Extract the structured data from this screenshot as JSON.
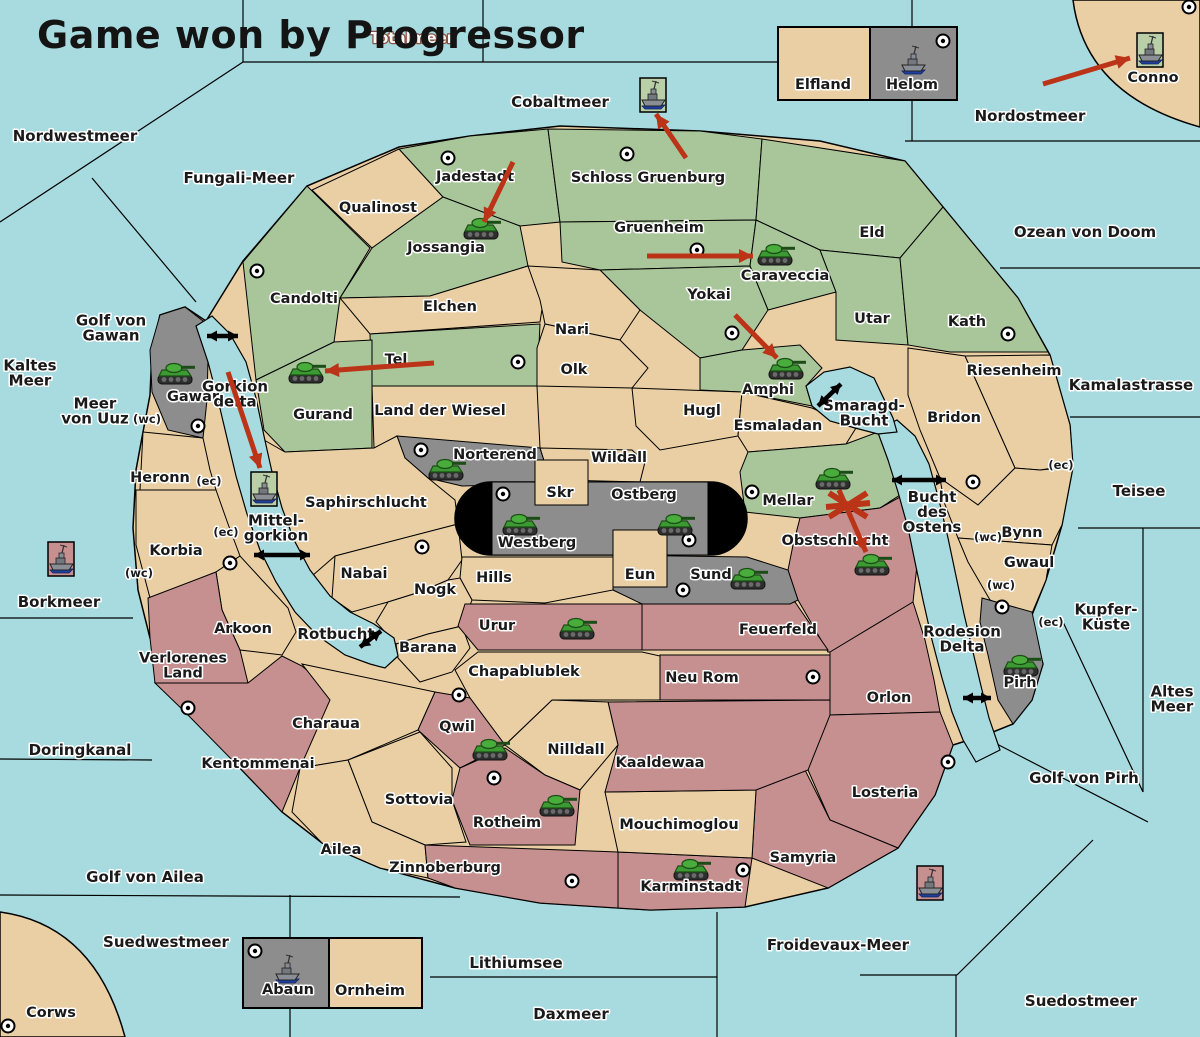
{
  "title": "Game won by Progressor",
  "colors": {
    "sea": "#a8dbe0",
    "land": "#e9cfa3",
    "green": "#a9c69a",
    "gray": "#8d8d8d",
    "rose": "#c69090",
    "capital": "#000000",
    "attack": "#bb3418",
    "link": "#000000",
    "ship_frame_green": "#b8cfa8",
    "ship_frame_rose": "#c69090"
  },
  "seas": [
    {
      "name": "Nordwestmeer",
      "x": 75,
      "y": 136
    },
    {
      "name": "Totalmeer",
      "x": 412,
      "y": 38,
      "inverse": true
    },
    {
      "name": "Cobaltmeer",
      "x": 560,
      "y": 102
    },
    {
      "name": "Nordostmeer",
      "x": 1030,
      "y": 116
    },
    {
      "name": "Ozean von Doom",
      "x": 1085,
      "y": 232
    },
    {
      "name": "Fungali-Meer",
      "x": 239,
      "y": 178
    },
    {
      "name": "Kaltes\nMeer",
      "x": 30,
      "y": 373
    },
    {
      "name": "Meer\nvon Uuz",
      "x": 95,
      "y": 411
    },
    {
      "name": "Golf von\nGawan",
      "x": 111,
      "y": 328
    },
    {
      "name": "Gorkion\ndelta",
      "x": 235,
      "y": 394
    },
    {
      "name": "Kamalastrasse",
      "x": 1131,
      "y": 385
    },
    {
      "name": "Teisee",
      "x": 1139,
      "y": 491
    },
    {
      "name": "Bucht\ndes\nOstens",
      "x": 932,
      "y": 512
    },
    {
      "name": "Smaragd-\nBucht",
      "x": 864,
      "y": 413
    },
    {
      "name": "Borkmeer",
      "x": 59,
      "y": 602
    },
    {
      "name": "Mittel-\ngorkion",
      "x": 276,
      "y": 528
    },
    {
      "name": "Kupfer-\nKüste",
      "x": 1106,
      "y": 617
    },
    {
      "name": "Altes\nMeer",
      "x": 1172,
      "y": 699
    },
    {
      "name": "Golf von Pirh",
      "x": 1084,
      "y": 778
    },
    {
      "name": "Rodesion\nDelta",
      "x": 962,
      "y": 639
    },
    {
      "name": "Rotbucht",
      "x": 336,
      "y": 634
    },
    {
      "name": "Doringkanal",
      "x": 80,
      "y": 750
    },
    {
      "name": "Golf von Ailea",
      "x": 145,
      "y": 877
    },
    {
      "name": "Suedwestmeer",
      "x": 166,
      "y": 942
    },
    {
      "name": "Lithiumsee",
      "x": 516,
      "y": 963
    },
    {
      "name": "Daxmeer",
      "x": 571,
      "y": 1014
    },
    {
      "name": "Froidevaux-Meer",
      "x": 838,
      "y": 945
    },
    {
      "name": "Suedostmeer",
      "x": 1081,
      "y": 1001
    }
  ],
  "regions": [
    {
      "name": "Candolti",
      "kind": "green",
      "x": 304,
      "y": 299
    },
    {
      "name": "Qualinost",
      "kind": "neutral",
      "x": 378,
      "y": 208
    },
    {
      "name": "Jadestadt",
      "kind": "green",
      "x": 475,
      "y": 177
    },
    {
      "name": "Schloss Gruenburg",
      "kind": "green",
      "x": 648,
      "y": 178
    },
    {
      "name": "Jossangia",
      "kind": "green",
      "x": 446,
      "y": 248
    },
    {
      "name": "Gruenheim",
      "kind": "green",
      "x": 659,
      "y": 228
    },
    {
      "name": "Eld",
      "kind": "green",
      "x": 872,
      "y": 233
    },
    {
      "name": "Caraveccia",
      "kind": "green",
      "x": 785,
      "y": 276
    },
    {
      "name": "Yokai",
      "kind": "green",
      "x": 709,
      "y": 295
    },
    {
      "name": "Utar",
      "kind": "green",
      "x": 872,
      "y": 319
    },
    {
      "name": "Kath",
      "kind": "green",
      "x": 967,
      "y": 322
    },
    {
      "name": "Amphi",
      "kind": "green",
      "x": 768,
      "y": 390
    },
    {
      "name": "Elchen",
      "kind": "neutral",
      "x": 450,
      "y": 307
    },
    {
      "name": "Nari",
      "kind": "neutral",
      "x": 572,
      "y": 330
    },
    {
      "name": "Tel",
      "kind": "green",
      "x": 396,
      "y": 360
    },
    {
      "name": "Olk",
      "kind": "neutral",
      "x": 574,
      "y": 370
    },
    {
      "name": "Gurand",
      "kind": "green",
      "x": 323,
      "y": 415
    },
    {
      "name": "Land der Wiesel",
      "kind": "neutral",
      "x": 440,
      "y": 411
    },
    {
      "name": "Hugl",
      "kind": "neutral",
      "x": 702,
      "y": 411
    },
    {
      "name": "Esmaladan",
      "kind": "neutral",
      "x": 778,
      "y": 426
    },
    {
      "name": "Mellar",
      "kind": "green",
      "x": 788,
      "y": 501
    },
    {
      "name": "Obstschlucht",
      "kind": "rose",
      "x": 835,
      "y": 541
    },
    {
      "name": "Wildall",
      "kind": "neutral",
      "x": 619,
      "y": 458
    },
    {
      "name": "Norterend",
      "kind": "gray",
      "x": 495,
      "y": 455
    },
    {
      "name": "Saphirschlucht",
      "kind": "neutral",
      "x": 366,
      "y": 503
    },
    {
      "name": "Nabai",
      "kind": "neutral",
      "x": 364,
      "y": 574
    },
    {
      "name": "Hills",
      "kind": "neutral",
      "x": 494,
      "y": 578
    },
    {
      "name": "Nogk",
      "kind": "neutral",
      "x": 435,
      "y": 590
    },
    {
      "name": "Barana",
      "kind": "neutral",
      "x": 428,
      "y": 648
    },
    {
      "name": "Heronn",
      "kind": "neutral",
      "x": 160,
      "y": 478
    },
    {
      "name": "Korbia",
      "kind": "neutral",
      "x": 176,
      "y": 551
    },
    {
      "name": "Arkoon",
      "kind": "neutral",
      "x": 243,
      "y": 629
    },
    {
      "name": "Verlorenes Land",
      "kind": "rose",
      "label": "Verlorenes\nLand",
      "x": 183,
      "y": 666
    },
    {
      "name": "Kentommenai",
      "kind": "rose",
      "x": 258,
      "y": 764
    },
    {
      "name": "Charaua",
      "kind": "neutral",
      "x": 326,
      "y": 724
    },
    {
      "name": "Sottovia",
      "kind": "neutral",
      "x": 419,
      "y": 800
    },
    {
      "name": "Ailea",
      "kind": "neutral",
      "x": 341,
      "y": 850
    },
    {
      "name": "Urur",
      "kind": "rose",
      "x": 497,
      "y": 626
    },
    {
      "name": "Feuerfeld",
      "kind": "rose",
      "x": 778,
      "y": 630
    },
    {
      "name": "Sund",
      "kind": "gray",
      "x": 711,
      "y": 575
    },
    {
      "name": "Neu Rom",
      "kind": "rose",
      "x": 702,
      "y": 678
    },
    {
      "name": "Orlon",
      "kind": "rose",
      "x": 889,
      "y": 698
    },
    {
      "name": "Losteria",
      "kind": "rose",
      "x": 885,
      "y": 793
    },
    {
      "name": "Samyria",
      "kind": "rose",
      "x": 803,
      "y": 858
    },
    {
      "name": "Karminstadt",
      "kind": "rose",
      "x": 691,
      "y": 887
    },
    {
      "name": "Zinnoberburg",
      "kind": "rose",
      "x": 445,
      "y": 868
    },
    {
      "name": "Mouchimoglou",
      "kind": "neutral",
      "x": 679,
      "y": 825
    },
    {
      "name": "Kaaldewaa",
      "kind": "rose",
      "x": 660,
      "y": 763
    },
    {
      "name": "Nilldall",
      "kind": "neutral",
      "x": 576,
      "y": 750
    },
    {
      "name": "Chapablublek",
      "kind": "neutral",
      "x": 524,
      "y": 672
    },
    {
      "name": "Qwil",
      "kind": "rose",
      "x": 457,
      "y": 727
    },
    {
      "name": "Rotheim",
      "kind": "rose",
      "x": 507,
      "y": 823
    },
    {
      "name": "Gawar",
      "kind": "gray",
      "x": 193,
      "y": 397
    },
    {
      "name": "Riesenheim",
      "kind": "neutral",
      "x": 1014,
      "y": 371
    },
    {
      "name": "Bridon",
      "kind": "neutral",
      "x": 954,
      "y": 418
    },
    {
      "name": "Bynn",
      "kind": "neutral",
      "x": 1022,
      "y": 533
    },
    {
      "name": "Gwaul",
      "kind": "neutral",
      "x": 1029,
      "y": 563
    },
    {
      "name": "Pirh",
      "kind": "gray",
      "x": 1020,
      "y": 683
    },
    {
      "name": "Skr",
      "kind": "neutral",
      "x": 560,
      "y": 493
    },
    {
      "name": "Eun",
      "kind": "neutral",
      "x": 640,
      "y": 575
    },
    {
      "name": "Westberg",
      "kind": "gray",
      "x": 537,
      "y": 543
    },
    {
      "name": "Ostberg",
      "kind": "gray",
      "x": 644,
      "y": 495
    },
    {
      "name": "Conno",
      "kind": "corner",
      "x": 1153,
      "y": 78
    },
    {
      "name": "Corws",
      "kind": "corner",
      "x": 51,
      "y": 1013
    },
    {
      "name": "Elfland",
      "kind": "box-tan",
      "x": 823,
      "y": 85
    },
    {
      "name": "Helom",
      "kind": "box-gray",
      "x": 912,
      "y": 85
    },
    {
      "name": "Abaun",
      "kind": "box-gray",
      "x": 288,
      "y": 990
    },
    {
      "name": "Ornheim",
      "kind": "box-tan",
      "x": 370,
      "y": 991
    }
  ],
  "units": {
    "tanks": [
      {
        "location": "Jossangia",
        "x": 481,
        "y": 229
      },
      {
        "location": "Caraveccia",
        "x": 775,
        "y": 255
      },
      {
        "location": "Amphi",
        "x": 786,
        "y": 369
      },
      {
        "location": "Gurand",
        "x": 306,
        "y": 373
      },
      {
        "location": "Gawar",
        "x": 175,
        "y": 374
      },
      {
        "location": "Norterend",
        "x": 446,
        "y": 470
      },
      {
        "location": "Westberg",
        "x": 520,
        "y": 525
      },
      {
        "location": "Ostberg",
        "x": 675,
        "y": 525
      },
      {
        "location": "Mellar",
        "x": 833,
        "y": 479
      },
      {
        "location": "Obstschlucht",
        "x": 872,
        "y": 565
      },
      {
        "location": "Sund",
        "x": 748,
        "y": 579
      },
      {
        "location": "Urur",
        "x": 577,
        "y": 629
      },
      {
        "location": "Qwil",
        "x": 490,
        "y": 750
      },
      {
        "location": "Rotheim",
        "x": 557,
        "y": 806
      },
      {
        "location": "Karminstadt",
        "x": 691,
        "y": 870
      },
      {
        "location": "Pirh",
        "x": 1021,
        "y": 666
      }
    ],
    "ships": [
      {
        "location": "Cobaltmeer",
        "x": 653,
        "y": 95,
        "frame": "green"
      },
      {
        "location": "Conno",
        "x": 1150,
        "y": 50,
        "frame": "green"
      },
      {
        "location": "Helom",
        "x": 913,
        "y": 60,
        "frame": "none"
      },
      {
        "location": "Mittel-gorkion",
        "x": 264,
        "y": 489,
        "frame": "green"
      },
      {
        "location": "Borkmeer",
        "x": 61,
        "y": 559,
        "frame": "rose"
      },
      {
        "location": "Abaun",
        "x": 287,
        "y": 969,
        "frame": "none"
      },
      {
        "location": "Froidevaux-Meer",
        "x": 930,
        "y": 883,
        "frame": "rose"
      }
    ]
  },
  "cities": [
    [
      448,
      158
    ],
    [
      627,
      154
    ],
    [
      697,
      250
    ],
    [
      732,
      333
    ],
    [
      1008,
      334
    ],
    [
      518,
      362
    ],
    [
      257,
      271
    ],
    [
      198,
      426
    ],
    [
      421,
      450
    ],
    [
      503,
      494
    ],
    [
      689,
      540
    ],
    [
      752,
      492
    ],
    [
      973,
      482
    ],
    [
      230,
      563
    ],
    [
      422,
      547
    ],
    [
      683,
      590
    ],
    [
      188,
      708
    ],
    [
      459,
      695
    ],
    [
      494,
      778
    ],
    [
      572,
      881
    ],
    [
      743,
      870
    ],
    [
      813,
      677
    ],
    [
      948,
      762
    ],
    [
      1002,
      607
    ],
    [
      943,
      41
    ],
    [
      255,
      951
    ],
    [
      8,
      1026
    ],
    [
      1189,
      7
    ]
  ],
  "attack_arrows": [
    {
      "x1": 513,
      "y1": 162,
      "x2": 484,
      "y2": 222
    },
    {
      "x1": 647,
      "y1": 256,
      "x2": 753,
      "y2": 256
    },
    {
      "x1": 735,
      "y1": 315,
      "x2": 777,
      "y2": 358
    },
    {
      "x1": 434,
      "y1": 363,
      "x2": 325,
      "y2": 371
    },
    {
      "x1": 228,
      "y1": 372,
      "x2": 260,
      "y2": 468
    },
    {
      "x1": 839,
      "y1": 490,
      "x2": 866,
      "y2": 552
    },
    {
      "x1": 1043,
      "y1": 84,
      "x2": 1130,
      "y2": 58
    },
    {
      "x1": 686,
      "y1": 158,
      "x2": 656,
      "y2": 114
    }
  ],
  "link_arrows": [
    {
      "x1": 207,
      "y1": 336,
      "x2": 238,
      "y2": 336
    },
    {
      "x1": 818,
      "y1": 406,
      "x2": 841,
      "y2": 384
    },
    {
      "x1": 892,
      "y1": 480,
      "x2": 946,
      "y2": 480
    },
    {
      "x1": 254,
      "y1": 555,
      "x2": 310,
      "y2": 555
    },
    {
      "x1": 360,
      "y1": 647,
      "x2": 381,
      "y2": 631
    },
    {
      "x1": 963,
      "y1": 698,
      "x2": 991,
      "y2": 698
    }
  ],
  "blocked_marker": {
    "x": 848,
    "y": 505
  },
  "coast_badges": [
    {
      "text": "(wc)",
      "x": 147,
      "y": 419
    },
    {
      "text": "(ec)",
      "x": 209,
      "y": 481
    },
    {
      "text": "(ec)",
      "x": 226,
      "y": 532
    },
    {
      "text": "(wc)",
      "x": 139,
      "y": 573
    },
    {
      "text": "(ec)",
      "x": 1061,
      "y": 465
    },
    {
      "text": "(wc)",
      "x": 988,
      "y": 537
    },
    {
      "text": "(wc)",
      "x": 1001,
      "y": 585
    },
    {
      "text": "(ec)",
      "x": 1051,
      "y": 622
    }
  ]
}
